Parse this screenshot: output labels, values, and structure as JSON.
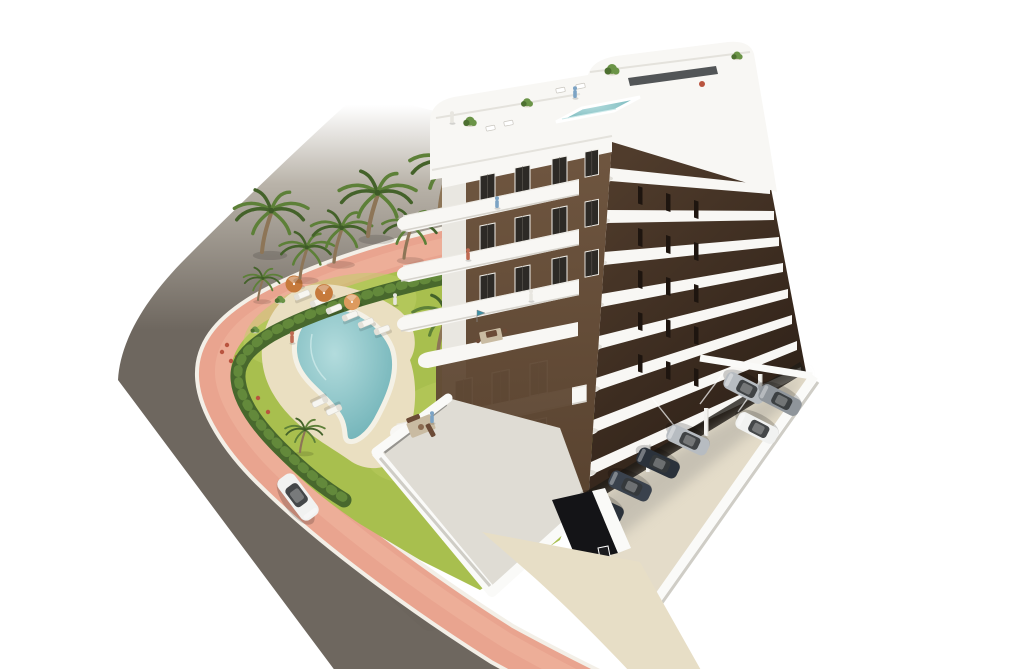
{
  "alt": "Aerial 3D architectural render of a white 8-storey apartment building with brown facades and curved white balconies, a rooftop terrace with plunge pool, a landscaped garden with freeform swimming pool, sun loungers, orange parasols and palm trees, a curving asphalt road with salmon-pink pavement, a white car on the road and a residents' parking area with parked cars.",
  "objects": {
    "building": "white apartment tower, brown window bays, rounded white balconies, rooftop pool terrace",
    "garden": "lawn with freeform turquoise pool, sun deck, loungers, parasols, palms, perimeter hedge",
    "road": "asphalt street curving around the plot, fading out at top",
    "sidewalk": "salmon pink pavement strip between road and hedge",
    "parking": "open-air parking beside building with white boundary wall and garage ramp",
    "vehicles": "one white car driving on the road, seven parked cars"
  },
  "colors": {
    "bg": "#ffffff",
    "road": "#6e675f",
    "road_mid": "#8d877d",
    "sidewalk": "#e9a48f",
    "sidewalk_line": "#f0b6a1",
    "curb": "#f3efe7",
    "lawn": "#a8bf4e",
    "lawn_light": "#bdd065",
    "hedge": "#48682d",
    "hedge_light": "#63893b",
    "palm_green": "#5d8038",
    "palm_green_dark": "#44622a",
    "palm_trunk": "#8d7557",
    "deck": "#ead fc1",
    "deck_fix": "#eadfc1",
    "pool_rim": "#f4f1e6",
    "pool_water": "#8fc9cc",
    "pool_water_deep": "#5fa8ae",
    "umbrella": "#c67a3c",
    "umbrella_light": "#dd9a5e",
    "lounger": "#f7f6f1",
    "white": "#f8f7f4",
    "white_shade": "#e9e7e1",
    "white_dark": "#d7d4cd",
    "facade_front": "#6f5640",
    "facade_front_dark": "#58422f",
    "facade_side": "#503c2c",
    "facade_side_dark": "#32241a",
    "window": "#2d2a26",
    "window_frame": "#f0eee8",
    "glass_dark": "#35383b",
    "roof_pool": "#aed6da",
    "terrace_floor": "#dfdcd4",
    "parking": "#e4dcc9",
    "parking_shadow": "#a9a69d",
    "wall": "#fafaf8",
    "wall_shade": "#cfcdc6",
    "garage": "#141417",
    "walkway": "#e7dec6",
    "car_white": "#f1f2f1",
    "car_silver": "#b7bcc1",
    "car_gray": "#8f959b",
    "car_dark": "#2b323b",
    "car_dark2": "#3a424d",
    "undercroft": "#1f1b16",
    "accent_red": "#b9543f",
    "flag_teal": "#3f8fa3",
    "person_blue": "#7ca3c4",
    "person_red": "#bf6a52",
    "person_light": "#e8e6e0",
    "plant_green": "#6b9447",
    "plant_dark": "#4d7030",
    "furn_brown": "#6b4a36",
    "rug": "#c9bba2"
  },
  "instances": {
    "palms": [
      {
        "x": 262,
        "y": 252,
        "s": 1.15
      },
      {
        "x": 300,
        "y": 278,
        "s": 0.85
      },
      {
        "x": 334,
        "y": 262,
        "s": 0.95
      },
      {
        "x": 368,
        "y": 236,
        "s": 1.2
      },
      {
        "x": 404,
        "y": 258,
        "s": 0.9
      },
      {
        "x": 440,
        "y": 208,
        "s": 1.25
      },
      {
        "x": 438,
        "y": 352,
        "s": 1.05
      },
      {
        "x": 300,
        "y": 452,
        "s": 0.62
      },
      {
        "x": 258,
        "y": 300,
        "s": 0.6
      }
    ],
    "loungers": [
      {
        "x": 302,
        "y": 295,
        "r": -22
      },
      {
        "x": 318,
        "y": 302,
        "r": -22
      },
      {
        "x": 334,
        "y": 309,
        "r": -22
      },
      {
        "x": 350,
        "y": 316,
        "r": -22
      },
      {
        "x": 366,
        "y": 323,
        "r": -22
      },
      {
        "x": 382,
        "y": 330,
        "r": -20
      },
      {
        "x": 320,
        "y": 402,
        "r": 155
      },
      {
        "x": 334,
        "y": 410,
        "r": 155
      }
    ],
    "umbrellas": [
      {
        "x": 294,
        "y": 284,
        "s": 1,
        "fill": "umbrella"
      },
      {
        "x": 324,
        "y": 293,
        "s": 1.05,
        "fill": "umbrella"
      },
      {
        "x": 352,
        "y": 302,
        "s": 0.95,
        "fill": "umbrella_light"
      }
    ],
    "front_windows": [
      {
        "x": 480,
        "y": 176
      },
      {
        "x": 515,
        "y": 168
      },
      {
        "x": 552,
        "y": 159
      },
      {
        "x": 480,
        "y": 226
      },
      {
        "x": 515,
        "y": 218
      },
      {
        "x": 552,
        "y": 209
      },
      {
        "x": 480,
        "y": 276
      },
      {
        "x": 515,
        "y": 268
      },
      {
        "x": 552,
        "y": 259
      },
      {
        "x": 585,
        "y": 152,
        "s": 0.9
      },
      {
        "x": 585,
        "y": 202,
        "s": 0.9
      },
      {
        "x": 585,
        "y": 252,
        "s": 0.9
      },
      {
        "x": 455,
        "y": 381,
        "s": 1.15
      },
      {
        "x": 492,
        "y": 373,
        "s": 1.15
      },
      {
        "x": 530,
        "y": 364,
        "s": 1.15
      },
      {
        "x": 455,
        "y": 438,
        "s": 1.1
      },
      {
        "x": 492,
        "y": 430,
        "s": 1.1
      },
      {
        "x": 530,
        "y": 421,
        "s": 1.1
      }
    ],
    "side_slits": [
      {
        "x": 638,
        "y": 186
      },
      {
        "x": 666,
        "y": 193
      },
      {
        "x": 694,
        "y": 200
      },
      {
        "x": 638,
        "y": 228
      },
      {
        "x": 666,
        "y": 235
      },
      {
        "x": 694,
        "y": 242
      },
      {
        "x": 638,
        "y": 270
      },
      {
        "x": 666,
        "y": 277
      },
      {
        "x": 694,
        "y": 284
      },
      {
        "x": 638,
        "y": 312
      },
      {
        "x": 666,
        "y": 319
      },
      {
        "x": 694,
        "y": 326
      },
      {
        "x": 638,
        "y": 354
      },
      {
        "x": 666,
        "y": 361
      },
      {
        "x": 694,
        "y": 368
      }
    ],
    "balconies": [
      {
        "x": 421,
        "y": 212
      },
      {
        "x": 421,
        "y": 262
      },
      {
        "x": 421,
        "y": 312
      },
      {
        "x": 416,
        "y": 420,
        "s": 1.08
      }
    ],
    "corner_wraps": [
      {
        "x": 603,
        "y": 176
      },
      {
        "x": 600,
        "y": 218
      },
      {
        "x": 597,
        "y": 260
      },
      {
        "x": 594,
        "y": 302
      },
      {
        "x": 592,
        "y": 344
      },
      {
        "x": 590,
        "y": 386
      },
      {
        "x": 588,
        "y": 428
      },
      {
        "x": 586,
        "y": 470
      }
    ],
    "roof_plants": [
      {
        "x": 470,
        "y": 122,
        "s": 0.9
      },
      {
        "x": 527,
        "y": 103,
        "s": 0.8
      },
      {
        "x": 612,
        "y": 70,
        "s": 1
      },
      {
        "x": 737,
        "y": 56,
        "s": 0.75
      }
    ],
    "terrace_plants": [
      {
        "x": 470,
        "y": 482,
        "s": 1
      },
      {
        "x": 494,
        "y": 503,
        "s": 0.9
      },
      {
        "x": 477,
        "y": 522,
        "s": 0.8
      },
      {
        "x": 508,
        "y": 340,
        "s": 0.7
      },
      {
        "x": 280,
        "y": 300,
        "s": 0.7
      },
      {
        "x": 255,
        "y": 330,
        "s": 0.6
      }
    ],
    "flowers": [
      {
        "x": 222,
        "y": 352
      },
      {
        "x": 231,
        "y": 361
      },
      {
        "x": 241,
        "y": 369
      },
      {
        "x": 227,
        "y": 345
      },
      {
        "x": 237,
        "y": 357
      },
      {
        "x": 258,
        "y": 398
      },
      {
        "x": 268,
        "y": 412
      }
    ],
    "pillars": [
      {
        "x": 646,
        "y": 444
      },
      {
        "x": 704,
        "y": 408
      },
      {
        "x": 758,
        "y": 374
      }
    ],
    "parked_cars": [
      {
        "x": 745,
        "y": 388,
        "r": 207,
        "fill": "car_silver"
      },
      {
        "x": 780,
        "y": 400,
        "r": 207,
        "fill": "car_gray"
      },
      {
        "x": 757,
        "y": 428,
        "r": 207,
        "fill": "car_white"
      },
      {
        "x": 688,
        "y": 440,
        "r": 205,
        "fill": "car_silver"
      },
      {
        "x": 658,
        "y": 463,
        "r": 205,
        "fill": "car_dark"
      },
      {
        "x": 630,
        "y": 486,
        "r": 205,
        "fill": "car_dark2"
      },
      {
        "x": 602,
        "y": 508,
        "r": 205,
        "fill": "car_dark"
      }
    ],
    "road_cars": [
      {
        "x": 298,
        "y": 497,
        "r": 53,
        "s": 1.15,
        "fill": "car_white"
      }
    ],
    "people": [
      {
        "x": 497,
        "y": 205,
        "fill": "person_blue"
      },
      {
        "x": 468,
        "y": 257,
        "fill": "person_red"
      },
      {
        "x": 531,
        "y": 298,
        "fill": "person_light"
      },
      {
        "x": 452,
        "y": 120,
        "fill": "person_light"
      },
      {
        "x": 575,
        "y": 95,
        "fill": "person_blue"
      },
      {
        "x": 292,
        "y": 340,
        "fill": "person_red"
      },
      {
        "x": 395,
        "y": 302,
        "fill": "person_light"
      },
      {
        "x": 432,
        "y": 420,
        "fill": "person_blue"
      }
    ]
  }
}
